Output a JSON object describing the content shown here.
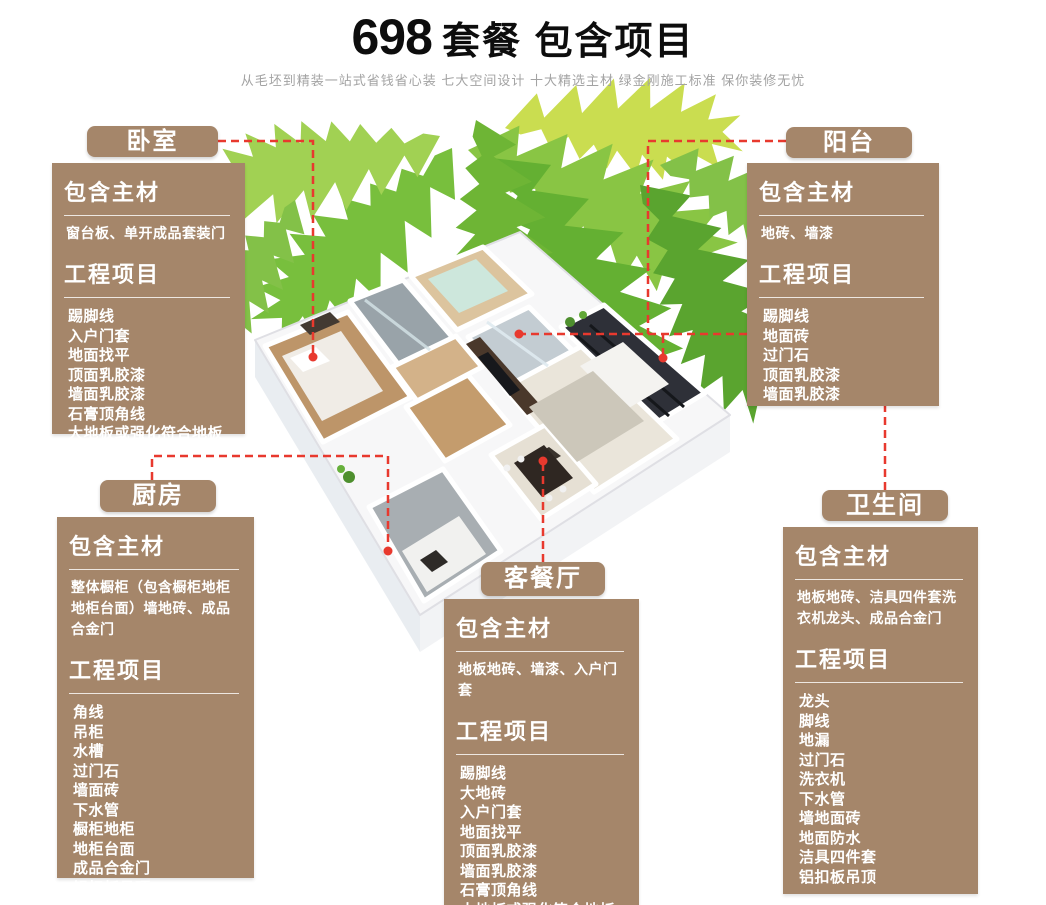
{
  "header": {
    "title_number": "698",
    "title_rest": "套餐 包含项目",
    "subtitle": "从毛坯到精装一站式省钱省心装 七大空间设计 十大精选主材 绿金刚施工标准 保你装修无忧"
  },
  "colors": {
    "panel_brown": "#a5866a",
    "accent_red": "#e8392e",
    "title_black": "#0d0d0d",
    "subtitle_gray": "#a3a3a3"
  },
  "sections": {
    "bedroom": {
      "tab": "卧室",
      "materials_title": "包含主材",
      "materials": "窗台板、单开成品套装门",
      "projects_title": "工程项目",
      "projects": [
        "踢脚线",
        "入户门套",
        "地面找平",
        "顶面乳胶漆",
        "墙面乳胶漆",
        "石膏顶角线",
        "大地板或强化符合地板"
      ]
    },
    "kitchen": {
      "tab": "厨房",
      "materials_title": "包含主材",
      "materials": "整体橱柜（包含橱柜地柜地柜台面）墙地砖、成品合金门",
      "projects_title": "工程项目",
      "projects": [
        "角线",
        "吊柜",
        "水槽",
        "过门石",
        "墙面砖",
        "下水管",
        "橱柜地柜",
        "地柜台面",
        "成品合金门",
        "铝扣板吊顶"
      ]
    },
    "living": {
      "tab": "客餐厅",
      "materials_title": "包含主材",
      "materials": "地板地砖、墙漆、入户门套",
      "projects_title": "工程项目",
      "projects": [
        "踢脚线",
        "大地砖",
        "入户门套",
        "地面找平",
        "顶面乳胶漆",
        "墙面乳胶漆",
        "石膏顶角线",
        "大地板或强化符合地板"
      ]
    },
    "balcony": {
      "tab": "阳台",
      "materials_title": "包含主材",
      "materials": "地砖、墙漆",
      "projects_title": "工程项目",
      "projects": [
        "踢脚线",
        "地面砖",
        "过门石",
        "顶面乳胶漆",
        "墙面乳胶漆"
      ]
    },
    "bathroom": {
      "tab": "卫生间",
      "materials_title": "包含主材",
      "materials": "地板地砖、洁具四件套洗衣机龙头、成品合金门",
      "projects_title": "工程项目",
      "projects": [
        "龙头",
        "脚线",
        "地漏",
        "过门石",
        "洗衣机",
        "下水管",
        "墙地面砖",
        "地面防水",
        "洁具四件套",
        "铝扣板吊顶"
      ]
    }
  }
}
